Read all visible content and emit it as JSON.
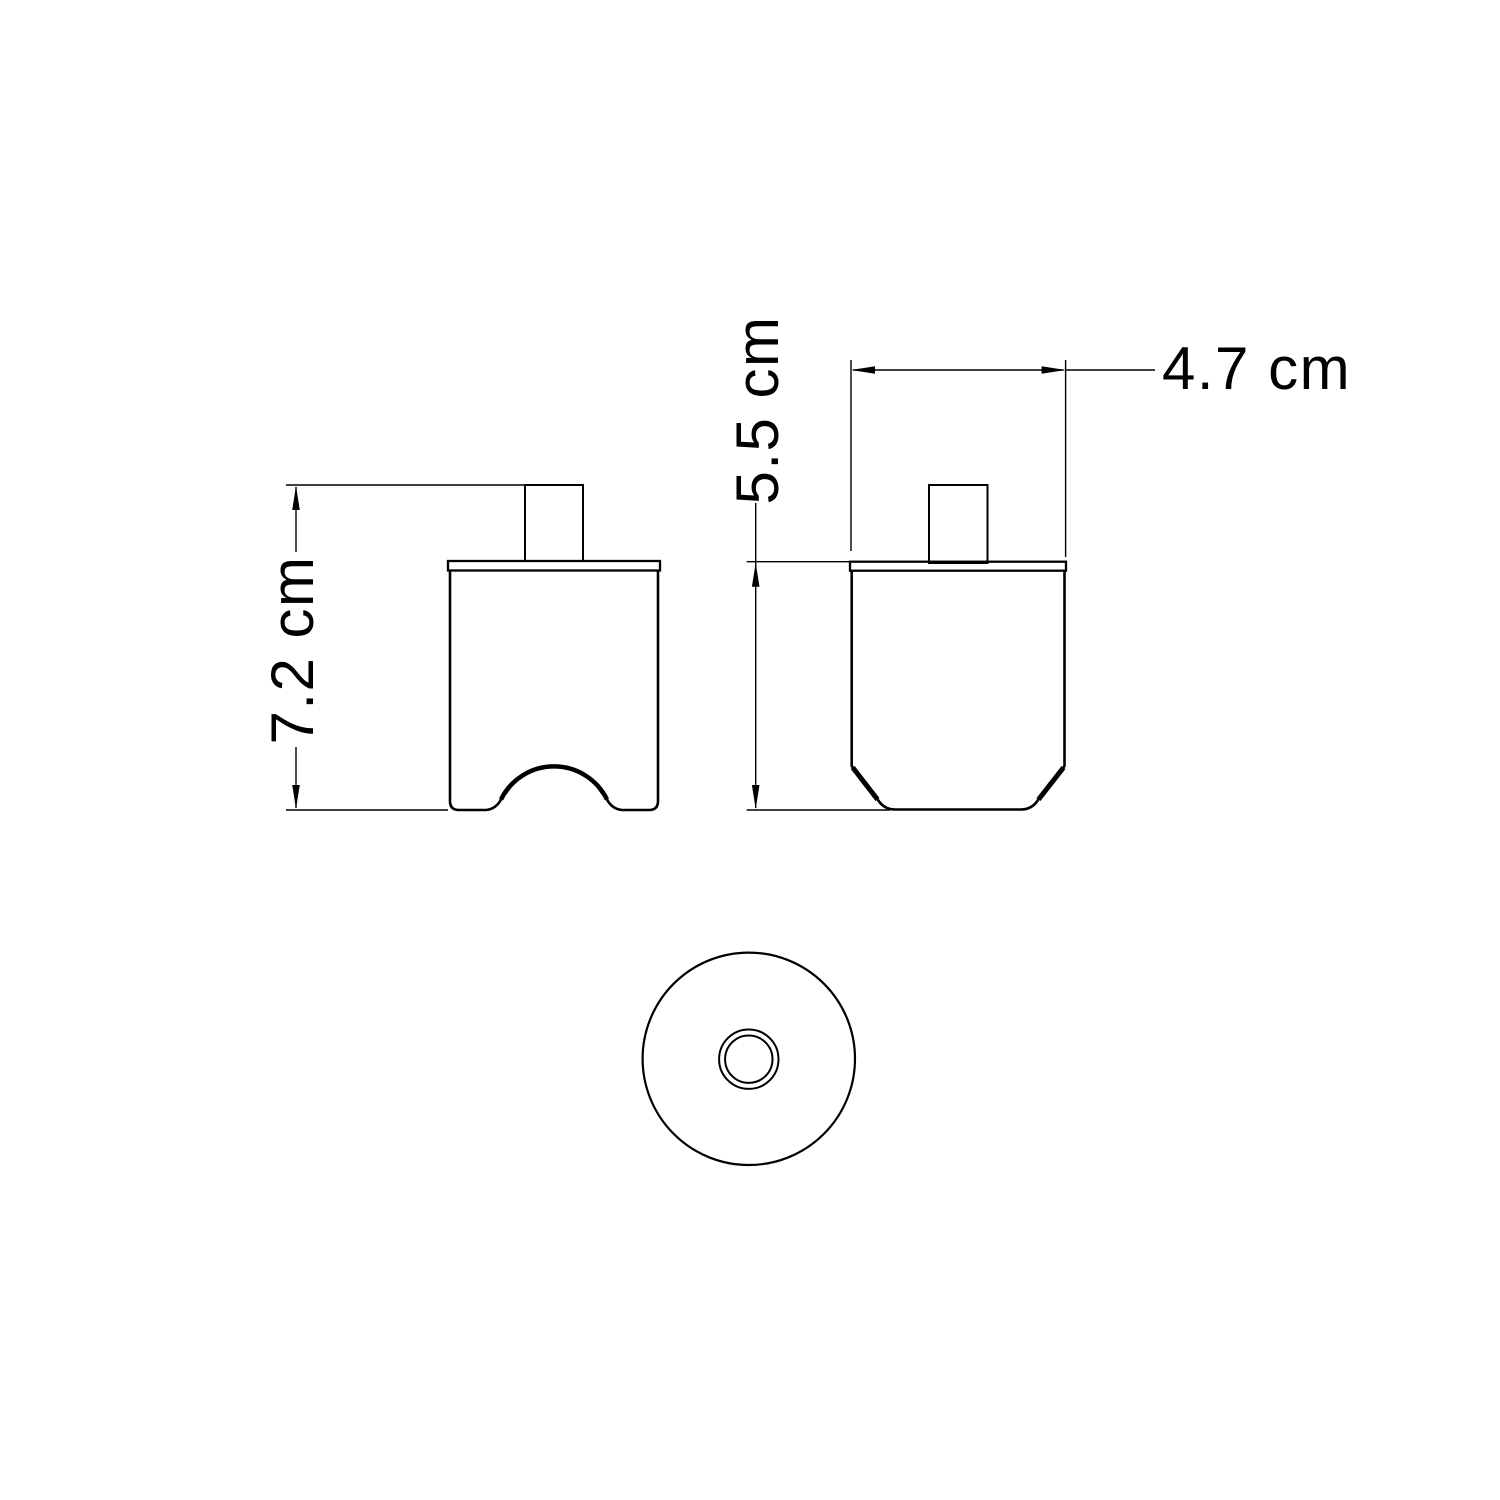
{
  "drawing": {
    "background_color": "#ffffff",
    "line_color": "#000000",
    "views": {
      "front_view": "front elevation with cable arch cutout",
      "side_view": "side elevation with chamfered base",
      "top_view": "top view with center hole"
    },
    "dimensions": {
      "height": {
        "label": "7.2 cm",
        "orientation": "vertical"
      },
      "body_height": {
        "label": "5.5 cm",
        "orientation": "vertical"
      },
      "width": {
        "label": "4.7 cm",
        "orientation": "horizontal"
      }
    }
  }
}
